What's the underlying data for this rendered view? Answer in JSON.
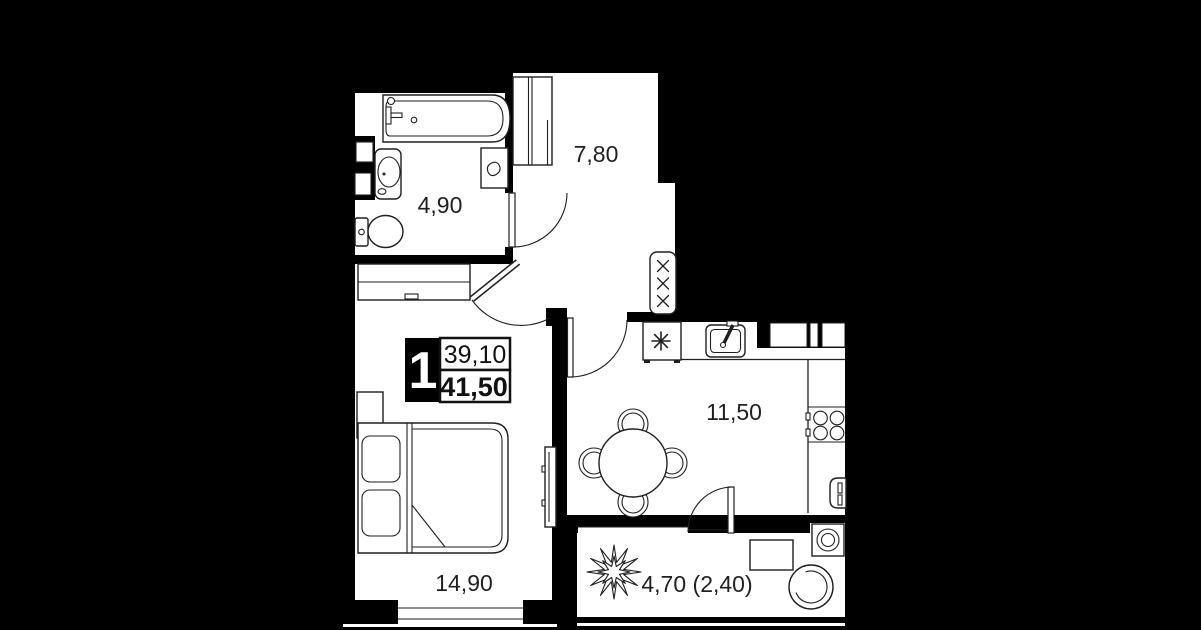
{
  "floor_plan": {
    "unit_badge": {
      "rooms_count": "1",
      "living_area": "39,10",
      "total_area": "41,50"
    },
    "rooms": {
      "bathroom": {
        "area": "4,90"
      },
      "hallway": {
        "area": "7,80"
      },
      "kitchen_living": {
        "area": "11,50"
      },
      "bedroom": {
        "area": "14,90"
      },
      "balcony": {
        "area": "4,70 (2,40)"
      }
    },
    "colors": {
      "background": "#000000",
      "floor": "#ffffff",
      "lines": "#1f1f1f"
    }
  }
}
